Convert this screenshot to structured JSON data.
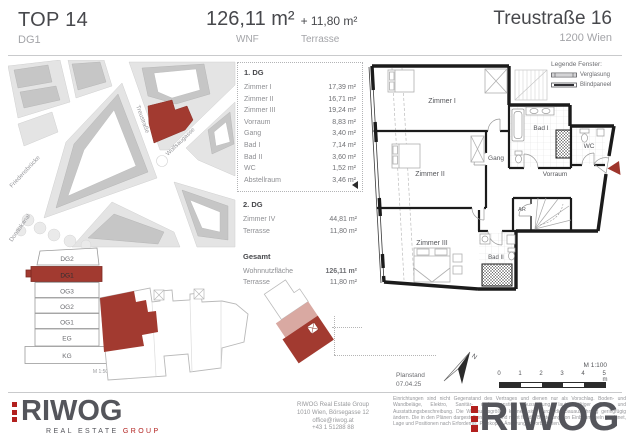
{
  "header": {
    "unit": "TOP 14",
    "level": "DG1",
    "area_value": "126,11 m²",
    "area_extra": "+ 11,80 m²",
    "area_label": "WNF",
    "area_extra_label": "Terrasse",
    "address_street": "Treustraße 16",
    "address_city": "1200 Wien"
  },
  "site_map": {
    "street_treustrasse": "Treustraße",
    "street_wolfsaugasse": "Wolfsaugasse",
    "street_friedensbruecke": "Friedensbrücke",
    "street_donaukanal": "Donaukanal"
  },
  "floor_stack": {
    "floors": [
      "DG2",
      "DG1",
      "OG3",
      "OG2",
      "OG1",
      "EG",
      "KG"
    ],
    "highlighted_floor": "DG1",
    "scale_label": "M 1:500"
  },
  "room_table": {
    "section1_title": "1. DG",
    "section1_rows": [
      {
        "label": "Zimmer I",
        "value": "17,39 m²"
      },
      {
        "label": "Zimmer II",
        "value": "16,71 m²"
      },
      {
        "label": "Zimmer III",
        "value": "19,24 m²"
      },
      {
        "label": "Vorraum",
        "value": "8,83 m²"
      },
      {
        "label": "Gang",
        "value": "3,40 m²"
      },
      {
        "label": "Bad I",
        "value": "7,14 m²"
      },
      {
        "label": "Bad II",
        "value": "3,60 m²"
      },
      {
        "label": "WC",
        "value": "1,52 m²"
      },
      {
        "label": "Abstellraum",
        "value": "3,46 m²"
      }
    ],
    "section2_title": "2. DG",
    "section2_rows": [
      {
        "label": "Zimmer IV",
        "value": "44,81 m²"
      },
      {
        "label": "Terrasse",
        "value": "11,80 m²"
      }
    ],
    "section3_title": "Gesamt",
    "section3_rows": [
      {
        "label": "Wohnnutzfläche",
        "value": "126,11 m²"
      },
      {
        "label": "Terrasse",
        "value": "11,80 m²"
      }
    ]
  },
  "floor_plan": {
    "rooms": {
      "zimmer1": "Zimmer I",
      "zimmer2": "Zimmer II",
      "zimmer3": "Zimmer III",
      "gang": "Gang",
      "bad1": "Bad I",
      "wc": "WC",
      "vorraum": "Vorraum",
      "ar": "AR",
      "bad2": "Bad II"
    },
    "legend": {
      "title": "Legende Fenster:",
      "glazing": "Verglasung",
      "blind": "Blindpaneel"
    }
  },
  "plan_meta": {
    "planstand_label": "Planstand",
    "planstand_date": "07.04.25",
    "north_label": "N",
    "scale_label": "M 1:100",
    "ticks": [
      "0",
      "1",
      "2",
      "3",
      "4",
      "5 m"
    ]
  },
  "footer": {
    "logo_text": "RIWOG",
    "logo_subtitle_1": "REAL ESTATE ",
    "logo_subtitle_2": "GROUP",
    "address_lines": [
      "RIWOG Real Estate Group",
      "1010 Wien, Börsegasse 12",
      "office@riwog.at",
      "+43 1 51288 88"
    ],
    "disclaimer": "Einrichtungen sind nicht Gegenstand des Vertrages und dienen nur als Vorschlag. Boden- und Wandbeläge, Elektro, Sanitär- und sonstige Ausstattung laut gültiger Bau- und Ausstattungsbeschreibung. Die Wohnungsgrößen können sich durch die Bauausführung geringfügig ändern. Die in den Plänen dargestellten Maße sind nicht für die Bestellung von Einbaumöbeln geeignet, Lage und Positionen nach Erfordernis. Plankopie. Änderungen vorbehalten.",
    "watermark": "RIWOG"
  },
  "colors": {
    "accent_red": "#a23a30",
    "accent_pink": "#d9a9a2",
    "logo_red": "#b2201e",
    "logo_gray": "#54555b",
    "text_dark": "#47484c",
    "text_gray": "#97989b"
  }
}
